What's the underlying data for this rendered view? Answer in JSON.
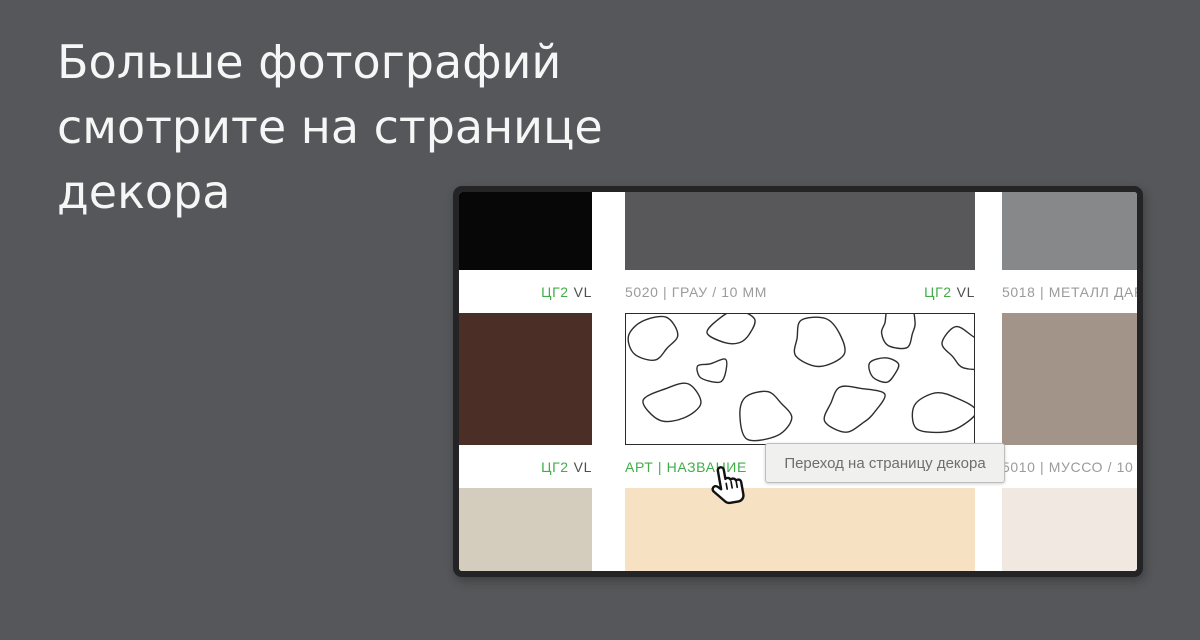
{
  "title": {
    "line1": "Больше фотографий",
    "line2": "смотрите на странице",
    "line3": "декора"
  },
  "colors": {
    "page_bg": "#55575a",
    "accent_green": "#3fae49",
    "label_gray": "#9b9b9b",
    "code_dark": "#4f4f4f",
    "frame": "#242427",
    "swatch_black": "#070708",
    "swatch_dark_gray": "#58585a",
    "swatch_light_gray": "#878889",
    "swatch_brown": "#4b2f27",
    "swatch_taupe": "#a29488",
    "swatch_greige": "#d4ccbc",
    "swatch_cream": "#f6e2c2",
    "swatch_off_white": "#f1e9e1"
  },
  "catalog": {
    "row1": {
      "col1": {
        "code": "ЦГ2",
        "suffix": "VL"
      },
      "col2": {
        "name": "5020 | ГРАУ / 10 ММ",
        "code": "ЦГ2",
        "suffix": "VL"
      },
      "col3": {
        "name": "5018 | МЕТАЛЛ ДАРК"
      }
    },
    "row2": {
      "col1": {
        "code": "ЦГ2",
        "suffix": "VL"
      },
      "col2": {
        "link": "АРТ | НАЗВАНИЕ"
      },
      "col3": {
        "name": "5010 | МУССО / 10 ММ"
      }
    }
  },
  "tooltip": {
    "text": "Переход на страницу декора"
  }
}
